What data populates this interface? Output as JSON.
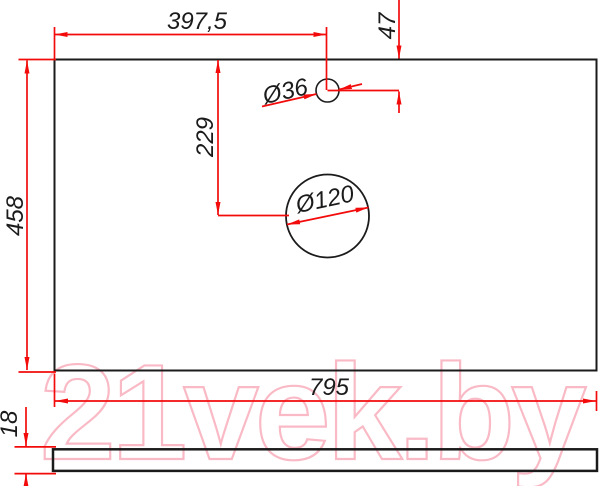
{
  "watermark": {
    "text": "21vek.by",
    "color": "#f9bac6"
  },
  "dimensions": {
    "top_width": "397,5",
    "hole_offset_top": "47",
    "small_hole_diameter": "Ø36",
    "large_hole_drop": "229",
    "large_hole_diameter": "Ø120",
    "panel_height": "458",
    "panel_width": "795",
    "panel_thickness": "18"
  },
  "colors": {
    "dimension_red": "#f30b0b",
    "outline_black": "#1b1b1b",
    "watermark_pink": "#f9bac6"
  }
}
